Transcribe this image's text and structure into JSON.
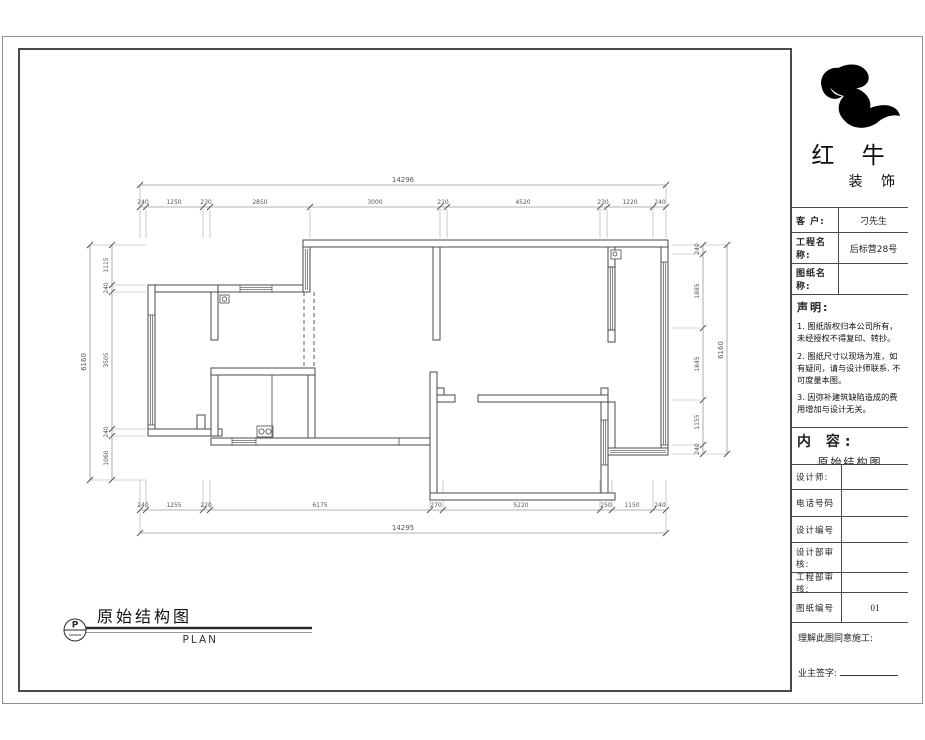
{
  "title_block": {
    "brand": {
      "line1": "红 牛",
      "line2": "装 饰"
    },
    "fields": [
      {
        "label": "客 户:",
        "value": "刁先生"
      },
      {
        "label": "工程名称:",
        "value": "后标营28号"
      },
      {
        "label": "图纸名称:",
        "value": ""
      }
    ],
    "declaration": {
      "heading": "声明:",
      "items": [
        "1. 图纸版权归本公司所有，未经授权不得复印、转抄。",
        "2. 图纸尺寸以现场为准，如有疑问，请与设计师联系. 不可度量本图。",
        "3. 因弥补建筑缺陷造成的费用增加与设计无关。"
      ]
    },
    "content": {
      "heading": "内 容:",
      "value": "原始结构图"
    },
    "rows": [
      {
        "label": "设计师:",
        "value": ""
      },
      {
        "label": "电话号码",
        "value": ""
      },
      {
        "label": "设计编号",
        "value": ""
      },
      {
        "label": "设计部审核:",
        "value": ""
      },
      {
        "label": "工程部审核:",
        "value": ""
      },
      {
        "label": "图纸编号",
        "value": "01"
      }
    ],
    "footer": {
      "line1": "理解此图同意施工:",
      "line2": "业主签字:"
    }
  },
  "drawing": {
    "title": "原始结构图",
    "subtitle": "PLAN",
    "section_mark": "P",
    "dimensions": {
      "top": {
        "total": "14296",
        "segments": [
          "240",
          "1250",
          "230",
          "2850",
          "3000",
          "210",
          "4520",
          "230",
          "1220",
          "240"
        ]
      },
      "bottom": {
        "total": "14295",
        "segments": [
          "240",
          "1255",
          "220",
          "6175",
          "270",
          "5220",
          "250",
          "1150",
          "240"
        ]
      },
      "left": {
        "total": "6160",
        "segments": [
          "1115",
          "240",
          "3505",
          "240",
          "1060"
        ]
      },
      "right": {
        "total": "6160",
        "segments": [
          "240",
          "1885",
          "1845",
          "1155",
          "240"
        ]
      }
    }
  }
}
